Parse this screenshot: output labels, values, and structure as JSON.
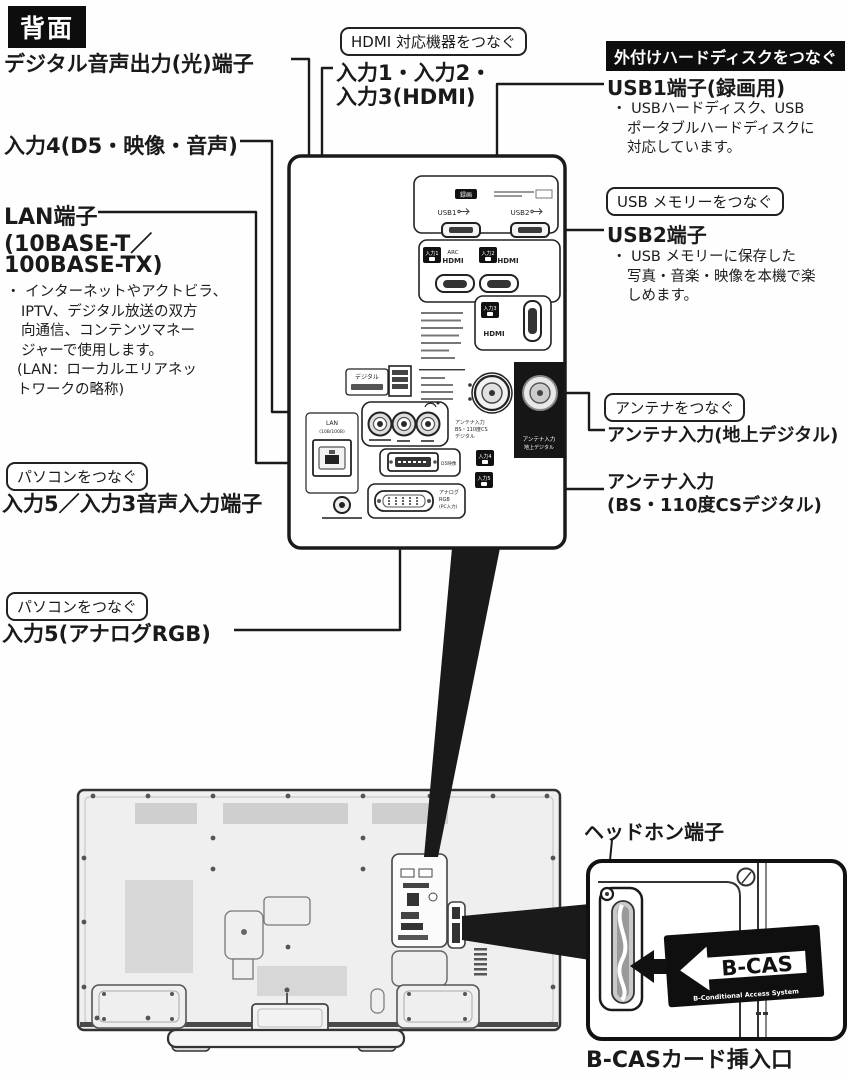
{
  "header": {
    "badge": "背面"
  },
  "callouts": {
    "digital_audio_out": "デジタル音声出力(光)端子",
    "input4": "入力4(D5・映像・音声)",
    "connect_hdmi": "HDMI 対応機器をつなぐ",
    "hdmi_inputs_line1": "入力1・入力2・",
    "hdmi_inputs_line2": "入力3(HDMI)",
    "connect_hdd": "外付けハードディスクをつなぐ",
    "usb1": "USB1端子(録画用)",
    "usb1_notes": [
      "・ USBハードディスク、USB",
      "ポータブルハードディスクに",
      "対応しています。"
    ],
    "connect_usb_memory": "USB メモリーをつなぐ",
    "usb2": "USB2端子",
    "usb2_notes": [
      "・ USB メモリーに保存した",
      "写真・音楽・映像を本機で楽",
      "しめます。"
    ],
    "lan_line1": "LAN端子",
    "lan_line2": "(10BASE-T／",
    "lan_line3": "100BASE-TX)",
    "lan_notes": [
      "・ インターネットやアクトビラ、",
      "IPTV、デジタル放送の双方",
      "向通信、コンテンツマネー",
      "ジャーで使用します。",
      "(LAN：ローカルエリアネッ",
      "トワークの略称)"
    ],
    "connect_pc1": "パソコンをつなぐ",
    "input5_audio": "入力5／入力3音声入力端子",
    "connect_pc2": "パソコンをつなぐ",
    "input5_rgb": "入力5(アナログRGB)",
    "connect_antenna": "アンテナをつなぐ",
    "antenna_terrestrial": "アンテナ入力(地上デジタル)",
    "antenna_bs_line1": "アンテナ入力",
    "antenna_bs_line2": "(BS・110度CSデジタル)",
    "headphone": "ヘッドホン端子",
    "bcas_slot": "B-CASカード挿入口"
  },
  "panel": {
    "rec_badge": "録画",
    "usb1_label": "USB1",
    "usb2_label": "USB2",
    "input1_badge": "入力1",
    "input2_badge": "入力2",
    "input3_badge": "入力3",
    "input4_badge": "入力4",
    "input5_badge": "入力5",
    "arc_label": "ARC",
    "hdmi_label_1": "HDMI",
    "hdmi_label_2": "HDMI",
    "hdmi_label_3": "HDMI",
    "digital_label": "デジタル",
    "lan_label": "LAN",
    "lan_speed_label": "(10B/100B)",
    "d5_label": "D5映像",
    "analog_rgb_line1": "アナログ",
    "analog_rgb_line2": "RGB",
    "analog_rgb_line3": "(PC入力)",
    "antenna_terr_line1": "アンテナ入力",
    "antenna_terr_line2": "地上デジタル",
    "antenna_bs_line1": "アンテナ入力",
    "antenna_bs_line2": "BS・110度CS",
    "antenna_bs_line3": "デジタル"
  },
  "inset": {
    "bcas_logo": "B-CAS",
    "bcas_sub": "B-Conditional Access System"
  },
  "colors": {
    "ink": "#1a1a1a",
    "tv_fill": "#efefef",
    "badge_bg": "#0d0d0d"
  }
}
